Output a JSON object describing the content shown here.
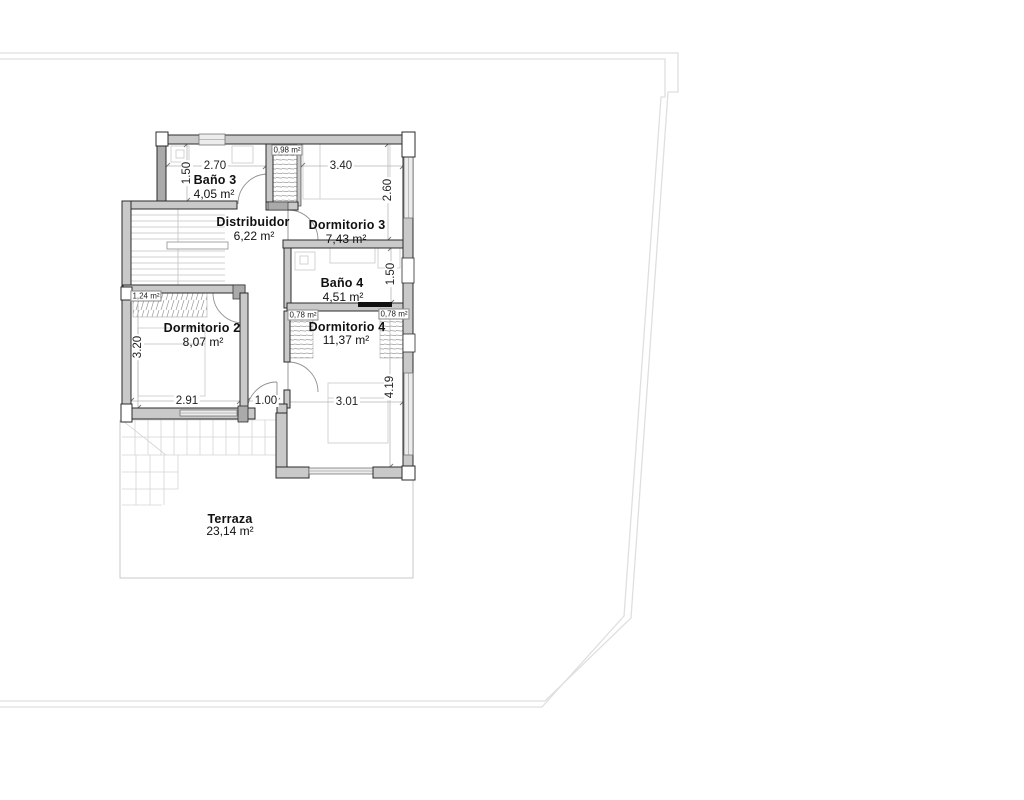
{
  "plan_title": "floor-plan-upper-level",
  "colors": {
    "wall_fill": "#c9c9c9",
    "wall_dark": "#aaaaaa",
    "wall_stroke": "#2b2b2b",
    "window_fill": "#ececec",
    "boundary": "#dfdfdf",
    "furniture": "#cfcfcf",
    "hatch": "#9a9a9a",
    "dim_line": "#b5b5b5",
    "text": "#111111"
  },
  "rooms": [
    {
      "id": "bano3",
      "name": "Baño 3",
      "area": "4,05 m²"
    },
    {
      "id": "distribuidor",
      "name": "Distribuidor",
      "area": "6,22 m²"
    },
    {
      "id": "dormitorio3",
      "name": "Dormitorio 3",
      "area": "7,43 m²"
    },
    {
      "id": "bano4",
      "name": "Baño 4",
      "area": "4,51 m²"
    },
    {
      "id": "dormitorio2",
      "name": "Dormitorio 2",
      "area": "8,07 m²"
    },
    {
      "id": "dormitorio4",
      "name": "Dormitorio 4",
      "area": "11,37 m²"
    },
    {
      "id": "terraza",
      "name": "Terraza",
      "area": "23,14 m²"
    }
  ],
  "closets": {
    "bano3_closet": "0,98 m²",
    "dorm2_closet": "1,24 m²",
    "dorm4_closet_left": "0,78 m²",
    "dorm4_closet_right": "0,78 m²"
  },
  "dimensions": {
    "bano3_w": "2.70",
    "bano3_h": "1.50",
    "dorm3_w": "3.40",
    "dorm3_h": "2.60",
    "bano4_h": "1.50",
    "dorm2_h": "3.20",
    "dorm2_w": "2.91",
    "entry_w": "1.00",
    "dorm4_w": "3.01",
    "dorm4_h": "4.19"
  }
}
